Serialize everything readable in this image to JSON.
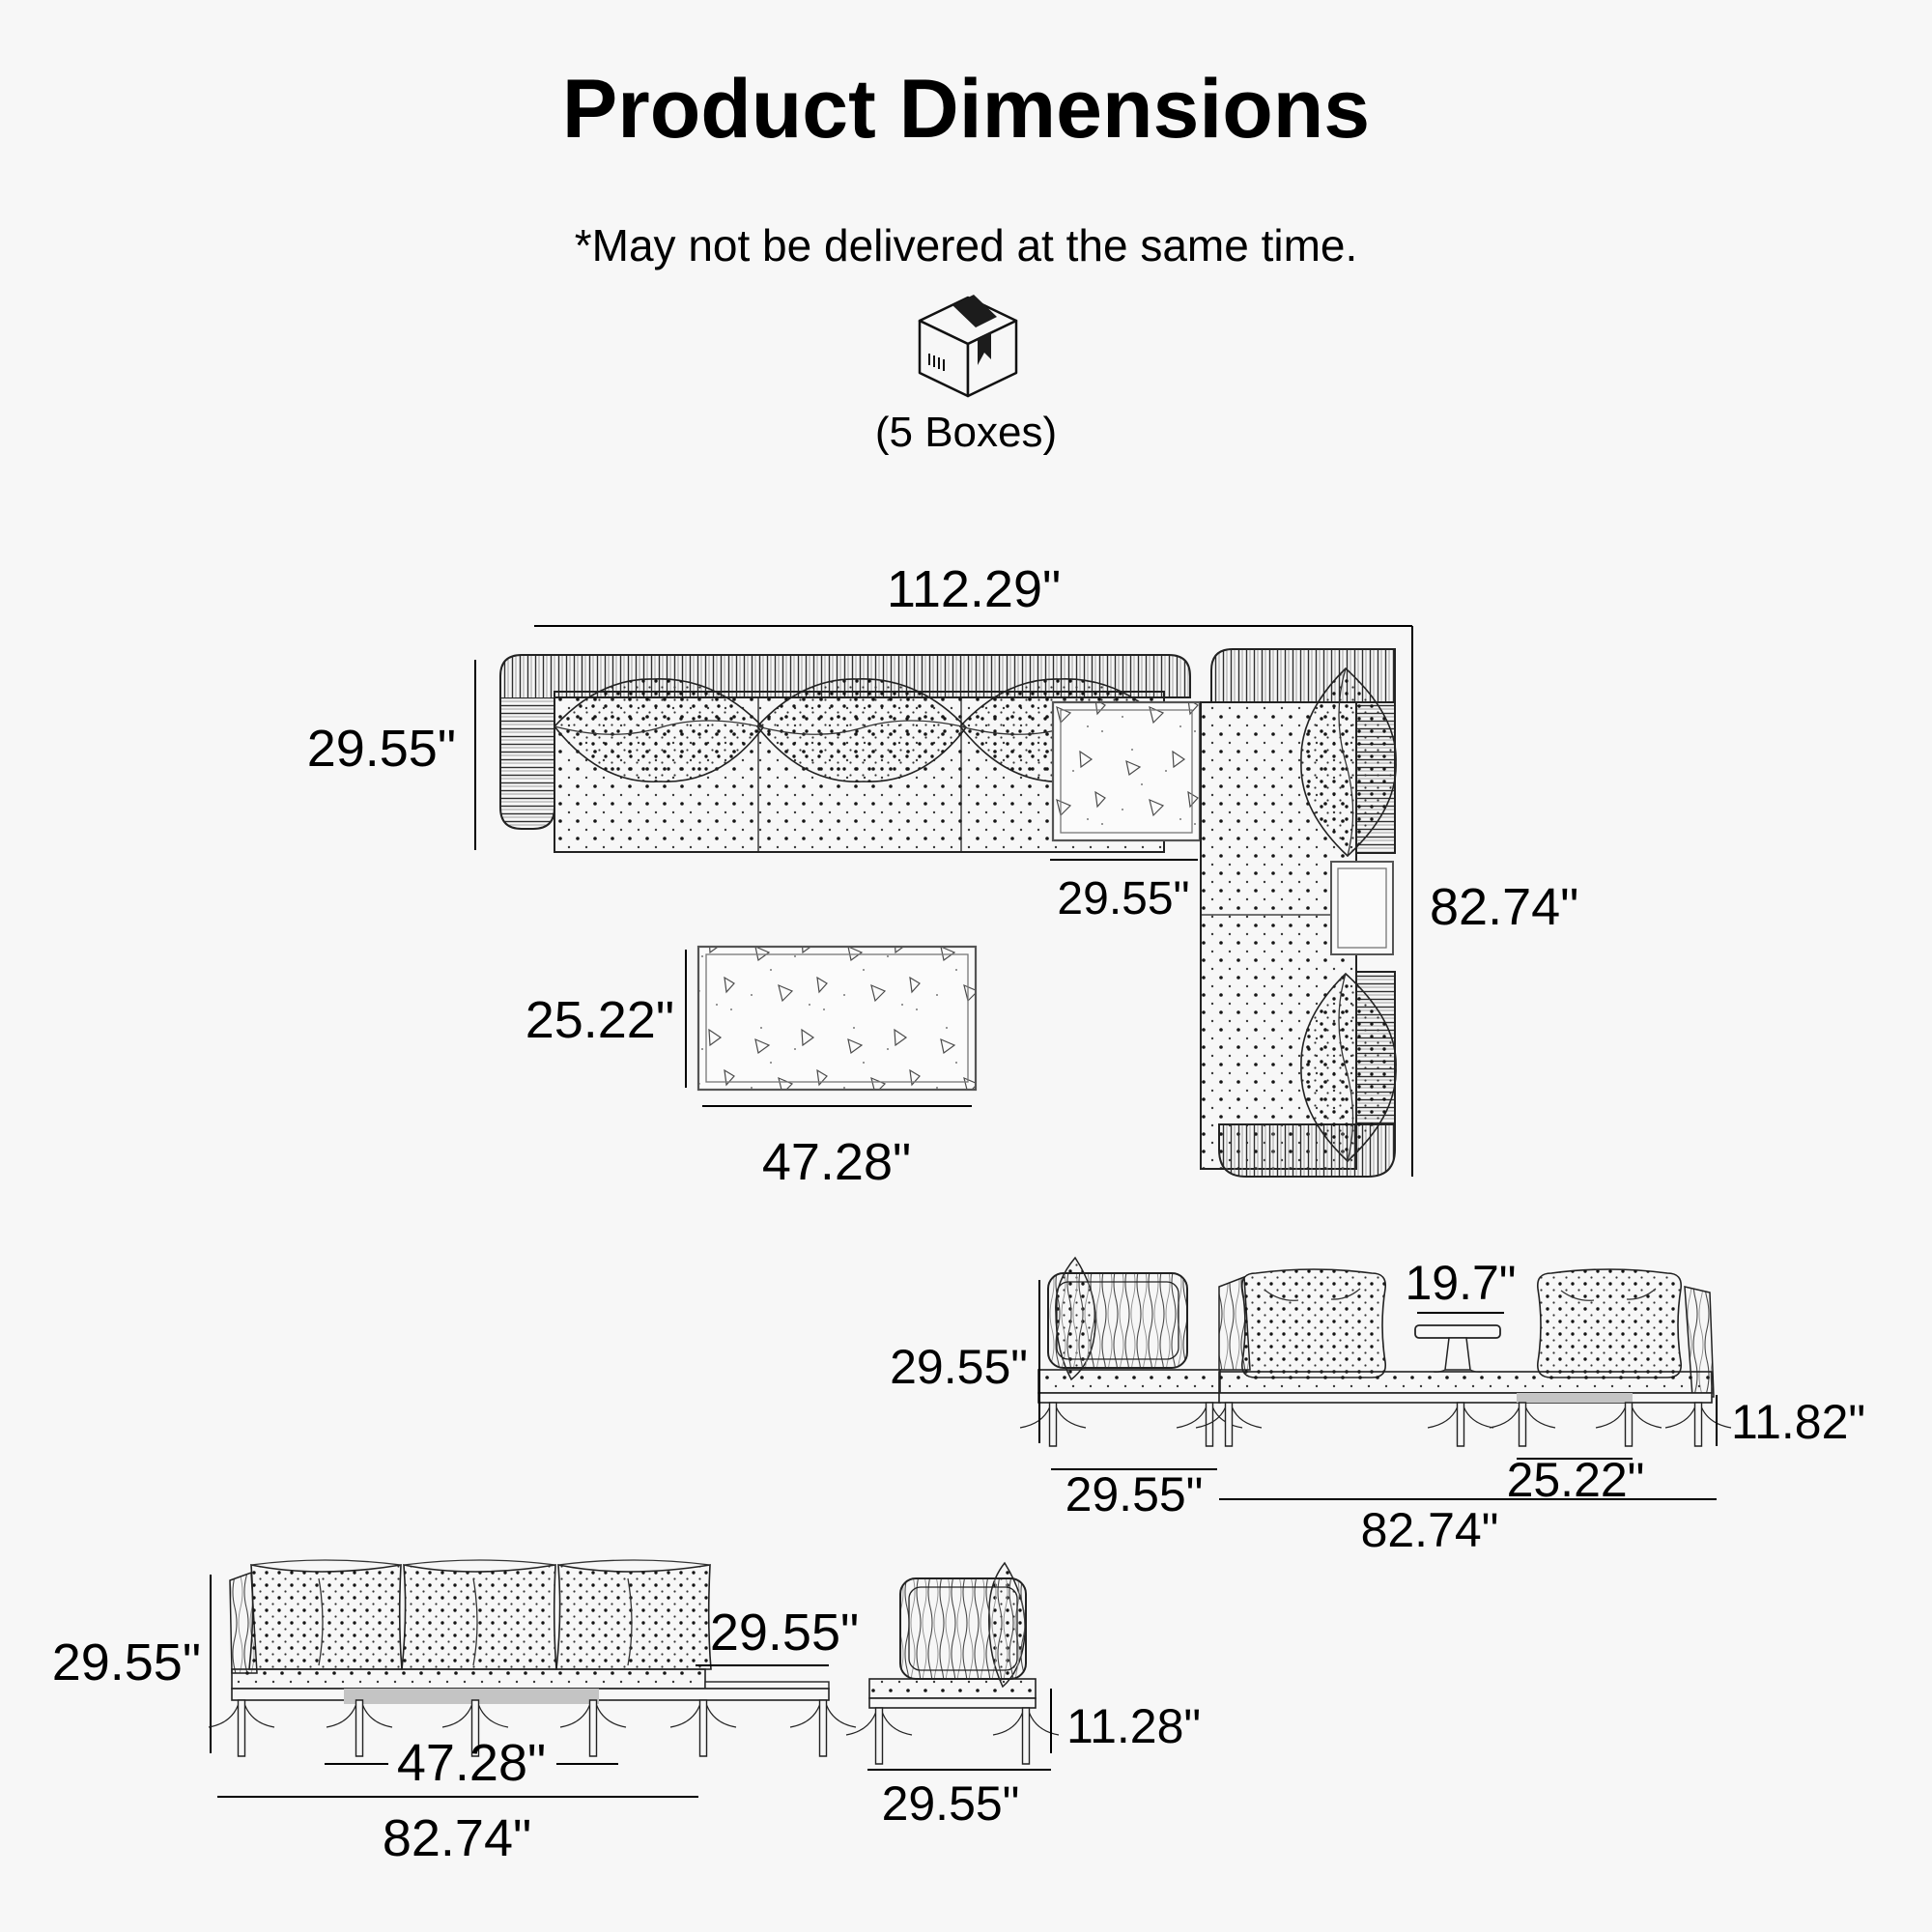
{
  "header": {
    "title": "Product Dimensions",
    "subtitle": "*May not be delivered at the same time.",
    "box_icon": "package-box-icon",
    "boxes_label": "(5 Boxes)"
  },
  "top_view": {
    "total_width": "112.29\"",
    "sofa_depth": "29.55\"",
    "corner_width": "29.55\"",
    "side_length": "82.74\"",
    "coffee_table": {
      "depth": "25.22\"",
      "width": "47.28\""
    }
  },
  "bench_view": {
    "back_height": "29.55\"",
    "table_width": "19.7\"",
    "seat_height": "11.82\"",
    "chair_width": "29.55\"",
    "module_width": "25.22\"",
    "total_width": "82.74\""
  },
  "sofa_view": {
    "back_height": "29.55\"",
    "depth": "29.55\"",
    "table_width": "47.28\"",
    "total_width": "82.74\""
  },
  "chair_view": {
    "seat_height": "11.28\"",
    "width": "29.55\""
  },
  "colors": {
    "background": "#f7f7f7",
    "line": "#222222",
    "text": "#000000",
    "shaded": "#c4c4c4"
  }
}
